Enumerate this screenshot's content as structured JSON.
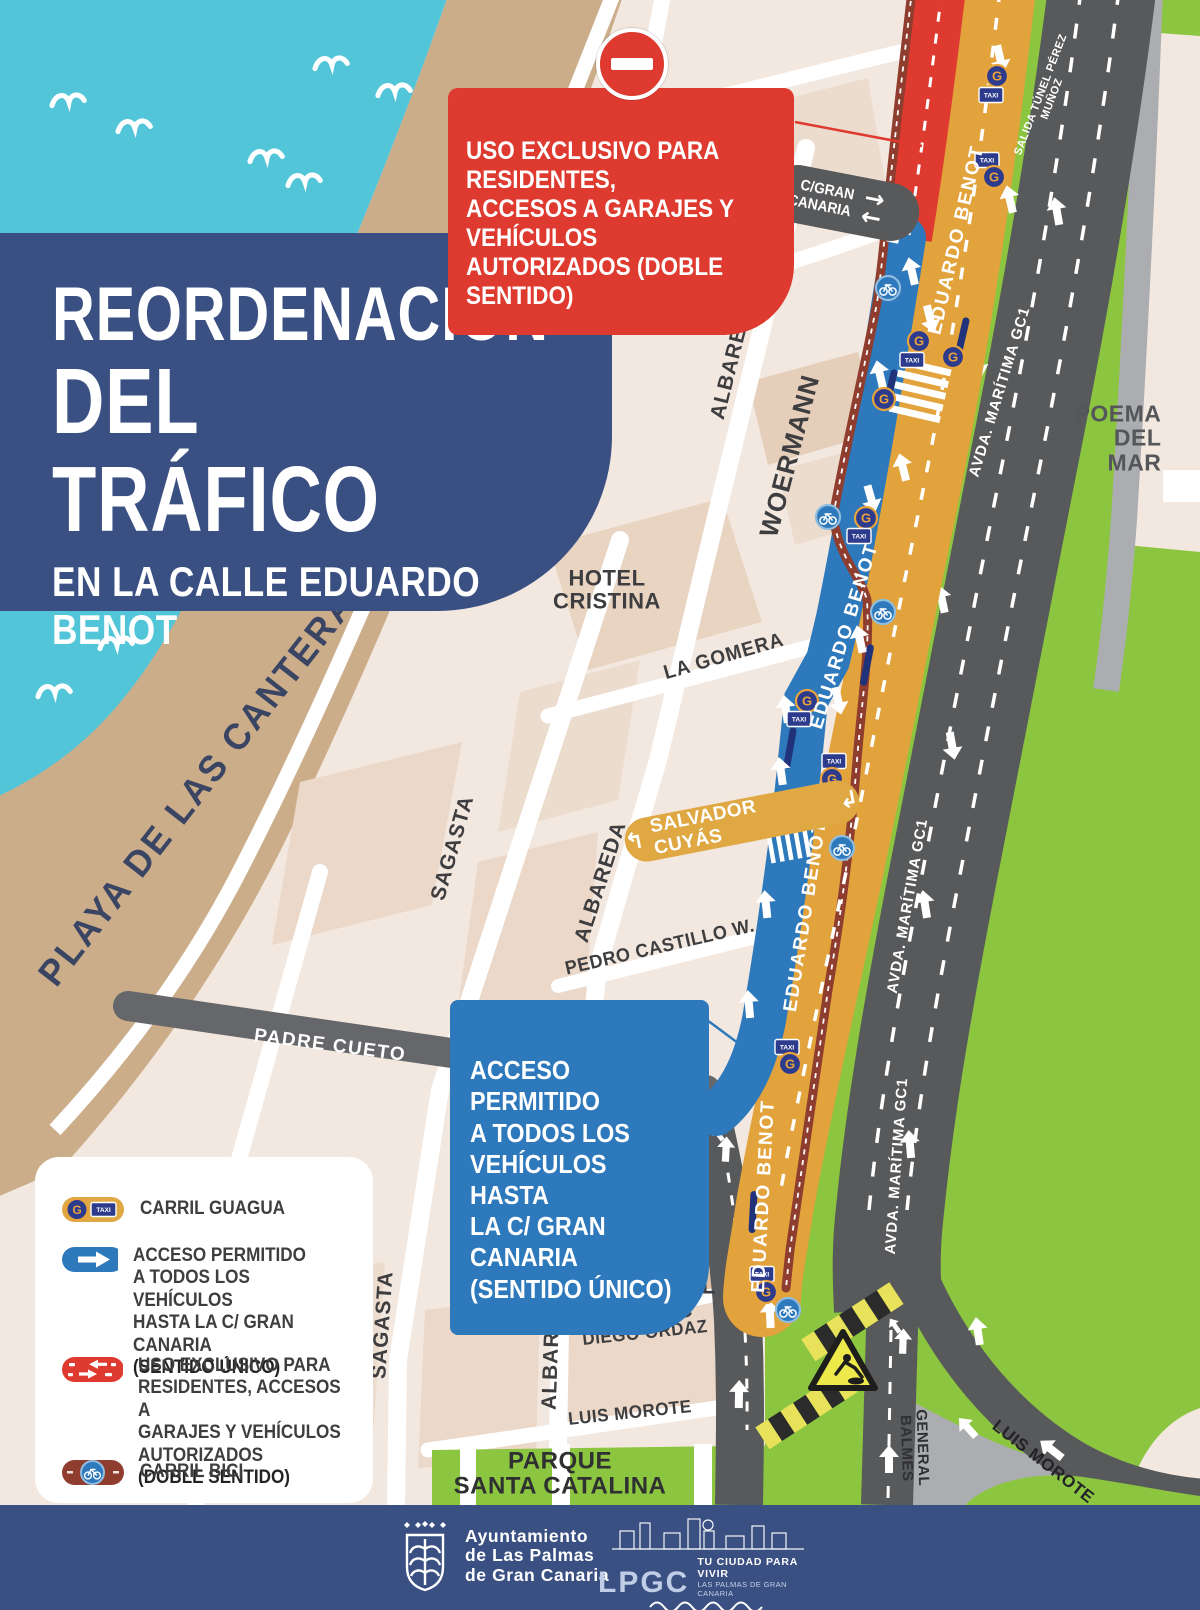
{
  "title": {
    "line1": "REORDENACIÓN",
    "line2": "DEL TRÁFICO",
    "line3": "EN LA CALLE EDUARDO BENOT"
  },
  "callouts": {
    "red": "USO EXCLUSIVO PARA RESIDENTES,\nACCESOS A GARAJES Y VEHÍCULOS\nAUTORIZADOS (DOBLE SENTIDO)",
    "blue": "ACCESO PERMITIDO\nA TODOS LOS\nVEHÍCULOS HASTA\nLA C/ GRAN CANARIA\n(SENTIDO ÚNICO)"
  },
  "map": {
    "labels": {
      "playa": "PLAYA DE LAS CANTERAS",
      "poema": "POEMA\nDEL MAR",
      "hotel_cristina": "HOTEL\nCRISTINA",
      "hotel_ac": "HOTEL\nAC",
      "bbva": "BBVA",
      "albareda": "ALBAREDA",
      "sagasta": "SAGASTA",
      "woermann": "WOERMANN",
      "la_gomera": "LA GOMERA",
      "pedro_castillo": "PEDRO CASTILLO W.",
      "padre_cueto": "PADRE CUETO",
      "alfredo_jones": "ALFREDO L. JONES",
      "diego_ordaz": "DIEGO ORDAZ",
      "luis_morote": "LUIS MOROTE",
      "general_balmes": "GENERAL\nBALMES",
      "parque": "PARQUE\nSANTA CATALINA",
      "eduardo_benot": "EDUARDO BENOT",
      "avda_maritima": "AVDA. MARÍTIMA GC1",
      "salida_tunel": "SALIDA TÚNEL PÉREZ MUÑOZ",
      "gran_canaria": "C/GRAN\nCANARIA",
      "salvador_cuyas": "SALVADOR CUYÁS"
    }
  },
  "icons": {
    "g": "G",
    "taxi": "TAXI",
    "arrow_right": "→",
    "arrow_left": "←",
    "turn_left": "↰",
    "turn_right": "↲"
  },
  "legend": {
    "items": [
      {
        "label": "CARRIL GUAGUA",
        "bold": ""
      },
      {
        "label": "ACCESO PERMITIDO\nA TODOS LOS VEHÍCULOS\nHASTA LA C/ GRAN CANARIA",
        "bold": "(SENTIDO ÚNICO)"
      },
      {
        "label": "USO EXCLUSIVO PARA\nRESIDENTES, ACCESOS A\nGARAJES Y VEHÍCULOS\nAUTORIZADOS",
        "bold": "(DOBLE SENTIDO)"
      },
      {
        "label": "CARRIL BICI",
        "bold": ""
      }
    ]
  },
  "footer": {
    "ayuntamiento": "Ayuntamiento\nde Las Palmas\nde Gran Canaria",
    "lpgc": "LPGC",
    "tagline": "TU CIUDAD PARA VIVIR",
    "tagline_sub": "LAS PALMAS DE GRAN CANARIA"
  },
  "colors": {
    "water": "#53C5D8",
    "beach": "#CBAD8A",
    "navy": "#3A4F82",
    "red": "#DE3A2F",
    "blue": "#2E79BC",
    "orange": "#E2A33C",
    "green": "#8CC540",
    "road_dark": "#58595B",
    "road_light": "#ABADB0",
    "bike_maroon": "#8F3D2E"
  }
}
